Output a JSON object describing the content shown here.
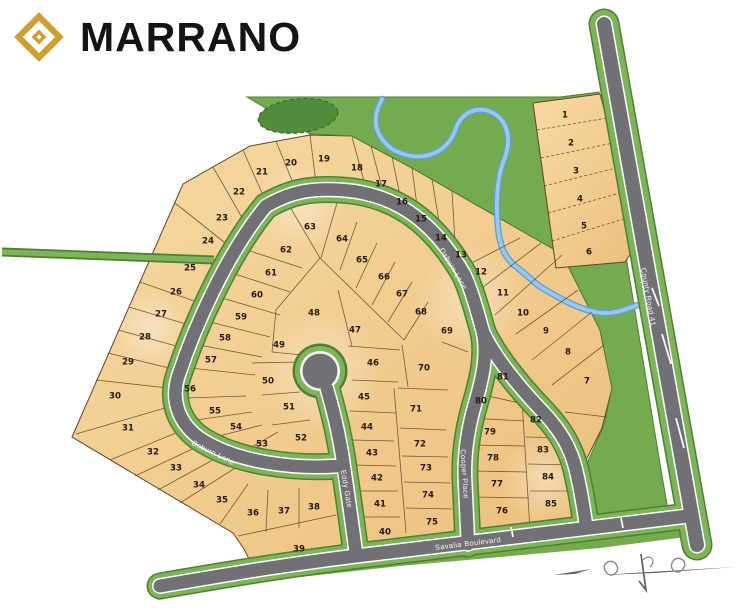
{
  "brand": {
    "name": "MARRANO"
  },
  "map": {
    "streets": [
      {
        "name": "Osburn Lane",
        "x": 453,
        "y": 269,
        "rotate": 59
      },
      {
        "name": "Osburn Lane",
        "x": 213,
        "y": 453,
        "rotate": 26
      },
      {
        "name": "Eddy Gate",
        "x": 346,
        "y": 489,
        "rotate": 80
      },
      {
        "name": "Cooper Place",
        "x": 464,
        "y": 474,
        "rotate": 86
      },
      {
        "name": "Savalia Boulevard",
        "x": 468,
        "y": 544,
        "rotate": -7
      },
      {
        "name": "County Road 41",
        "x": 648,
        "y": 297,
        "rotate": 80
      }
    ],
    "lots": [
      [
        1,
        565,
        115
      ],
      [
        2,
        571,
        143
      ],
      [
        3,
        576,
        171
      ],
      [
        4,
        580,
        199
      ],
      [
        5,
        584,
        226
      ],
      [
        6,
        589,
        252
      ],
      [
        7,
        587,
        381
      ],
      [
        8,
        568,
        352
      ],
      [
        9,
        546,
        331
      ],
      [
        10,
        523,
        313
      ],
      [
        11,
        503,
        293
      ],
      [
        12,
        481,
        272
      ],
      [
        13,
        461,
        255
      ],
      [
        14,
        441,
        238
      ],
      [
        15,
        421,
        219
      ],
      [
        16,
        402,
        202
      ],
      [
        17,
        381,
        184
      ],
      [
        18,
        357,
        168
      ],
      [
        19,
        324,
        159
      ],
      [
        20,
        291,
        163
      ],
      [
        21,
        262,
        172
      ],
      [
        22,
        239,
        192
      ],
      [
        23,
        222,
        218
      ],
      [
        24,
        208,
        241
      ],
      [
        25,
        190,
        268
      ],
      [
        26,
        176,
        292
      ],
      [
        27,
        161,
        314
      ],
      [
        28,
        145,
        337
      ],
      [
        29,
        128,
        362
      ],
      [
        30,
        115,
        396
      ],
      [
        31,
        128,
        428
      ],
      [
        32,
        153,
        452
      ],
      [
        33,
        176,
        468
      ],
      [
        34,
        199,
        485
      ],
      [
        35,
        222,
        500
      ],
      [
        36,
        253,
        513
      ],
      [
        37,
        284,
        511
      ],
      [
        38,
        314,
        507
      ],
      [
        39,
        299,
        549
      ],
      [
        40,
        385,
        532
      ],
      [
        41,
        380,
        504
      ],
      [
        42,
        377,
        478
      ],
      [
        43,
        372,
        453
      ],
      [
        44,
        367,
        427
      ],
      [
        45,
        364,
        397
      ],
      [
        46,
        373,
        363
      ],
      [
        47,
        355,
        330
      ],
      [
        48,
        314,
        313
      ],
      [
        49,
        279,
        345
      ],
      [
        50,
        268,
        381
      ],
      [
        51,
        289,
        407
      ],
      [
        52,
        301,
        438
      ],
      [
        53,
        262,
        444
      ],
      [
        54,
        236,
        427
      ],
      [
        55,
        215,
        411
      ],
      [
        56,
        190,
        389
      ],
      [
        57,
        211,
        360
      ],
      [
        58,
        225,
        338
      ],
      [
        59,
        241,
        317
      ],
      [
        60,
        257,
        295
      ],
      [
        61,
        271,
        273
      ],
      [
        62,
        286,
        250
      ],
      [
        63,
        310,
        227
      ],
      [
        64,
        342,
        239
      ],
      [
        65,
        362,
        260
      ],
      [
        66,
        384,
        277
      ],
      [
        67,
        402,
        294
      ],
      [
        68,
        421,
        312
      ],
      [
        69,
        447,
        331
      ],
      [
        70,
        424,
        368
      ],
      [
        71,
        416,
        409
      ],
      [
        72,
        420,
        444
      ],
      [
        73,
        426,
        468
      ],
      [
        74,
        428,
        495
      ],
      [
        75,
        432,
        522
      ],
      [
        76,
        502,
        511
      ],
      [
        77,
        497,
        484
      ],
      [
        78,
        493,
        458
      ],
      [
        79,
        490,
        432
      ],
      [
        80,
        481,
        401
      ],
      [
        81,
        503,
        377
      ],
      [
        82,
        536,
        420
      ],
      [
        83,
        543,
        450
      ],
      [
        84,
        548,
        477
      ],
      [
        85,
        551,
        504
      ]
    ],
    "colors": {
      "lot_line": "#5d4526",
      "green": "#74ab4e",
      "green_dark": "#4f7f33",
      "verge": "#7cb558",
      "road": "#717175",
      "road_label": "#f7f7f5",
      "water": "#639fd3",
      "water_light": "#97c9ee",
      "pond": "#518c3c",
      "number": "#26190d",
      "logo_gold": "#cf9f32"
    }
  }
}
